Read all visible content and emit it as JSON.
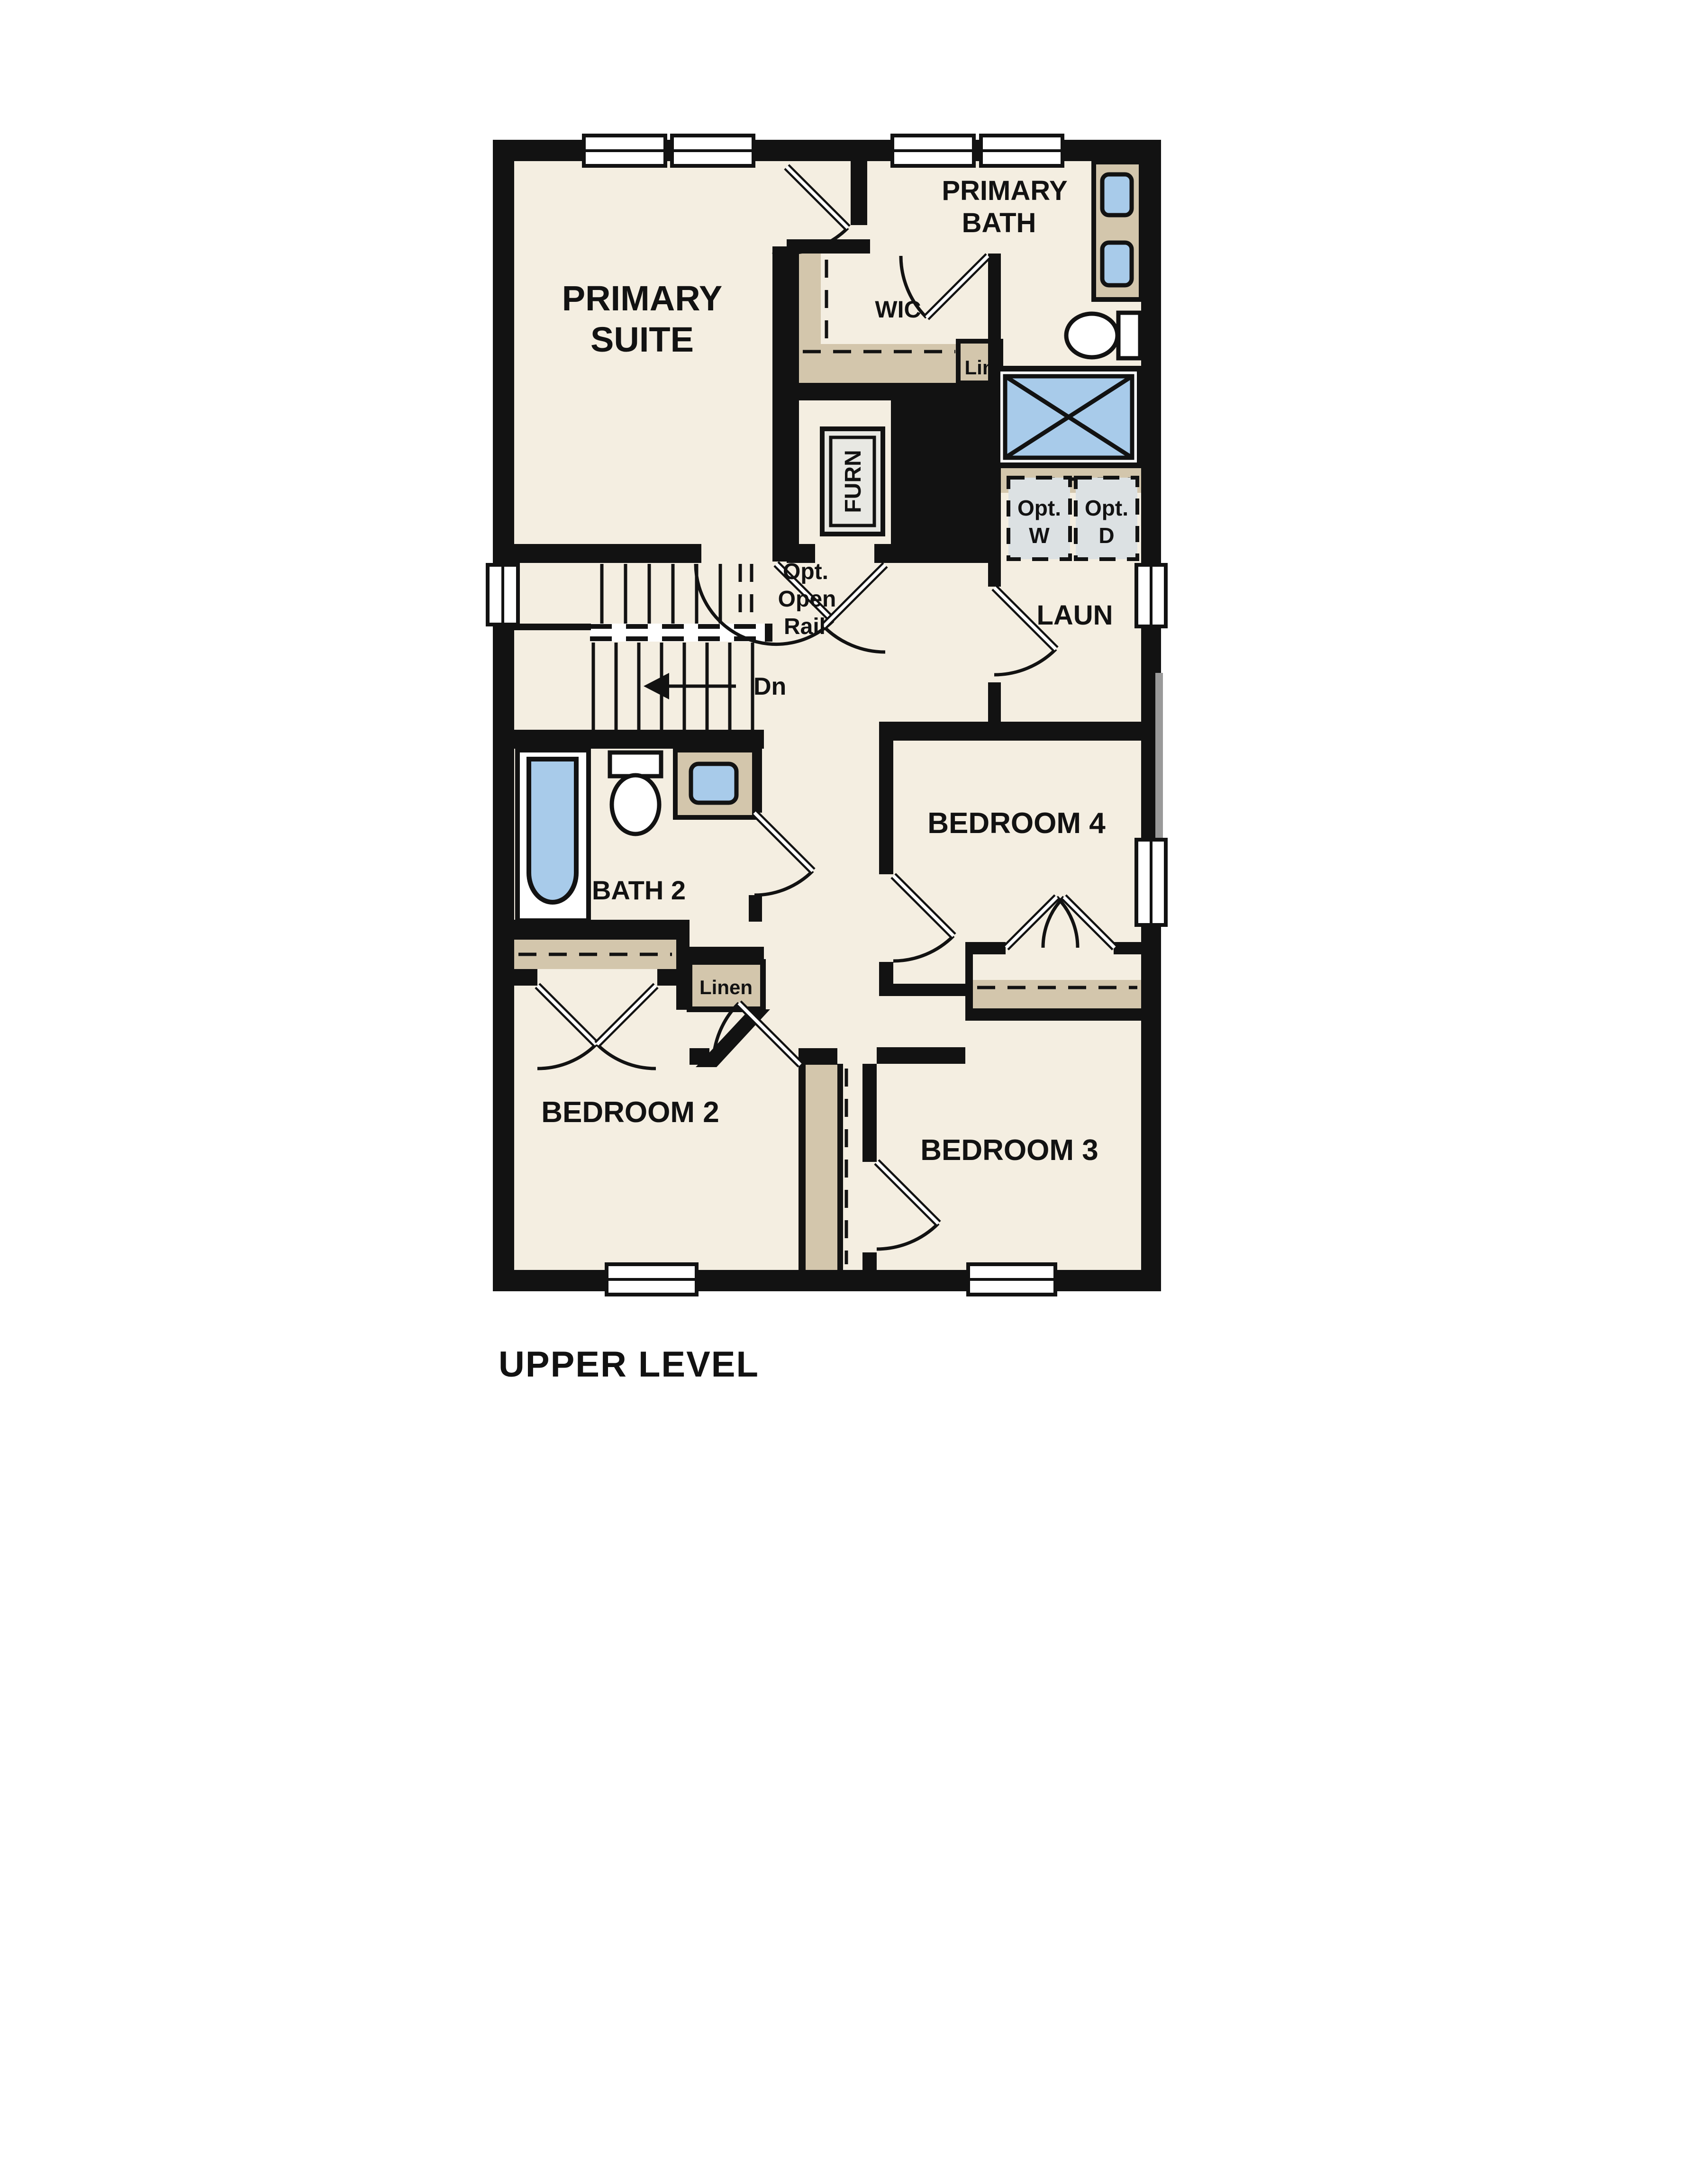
{
  "page_title": "UPPER LEVEL",
  "labels": {
    "primary_suite": [
      "PRIMARY",
      "SUITE"
    ],
    "primary_bath": [
      "PRIMARY",
      "BATH"
    ],
    "wic": "WIC",
    "lin": "Lin",
    "furn": "FURN",
    "opt_w": [
      "Opt.",
      "W"
    ],
    "opt_d": [
      "Opt.",
      "D"
    ],
    "laun": "LAUN",
    "open_rail": [
      "Opt.",
      "Open",
      "Rail"
    ],
    "down": "Dn",
    "bath2": "BATH 2",
    "linen": "Linen",
    "bedroom2": "BEDROOM 2",
    "bedroom3": "BEDROOM 3",
    "bedroom4": "BEDROOM 4"
  },
  "colors": {
    "background": "#ffffff",
    "wall": "#121212",
    "floor": "#f4eee1",
    "casework_tan": "#d3c6ac",
    "fixture_blue": "#a8cbea",
    "appliance_gray": "#dce1e3",
    "furnace_gray": "#e8e8e3"
  }
}
